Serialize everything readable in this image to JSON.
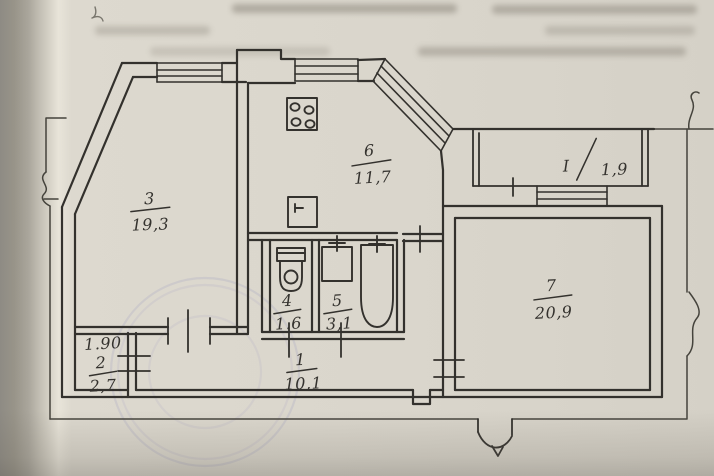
{
  "floor_plan": {
    "rooms": [
      {
        "number": "3",
        "area": "19,3"
      },
      {
        "number": "6",
        "area": "11,7"
      },
      {
        "number": "I",
        "area": "1,9"
      },
      {
        "number": "7",
        "area": "20,9"
      },
      {
        "number": "4",
        "area": "1.6"
      },
      {
        "number": "5",
        "area": "3,1"
      },
      {
        "number": "2",
        "area": "2,7",
        "dimension": "1.90"
      },
      {
        "number": "1",
        "area": "10,1"
      }
    ],
    "colors": {
      "paper": "#d9d5cb",
      "paper_edge": "#8e8b84",
      "ink": "#33312d",
      "stamp": "#8583bd"
    }
  }
}
